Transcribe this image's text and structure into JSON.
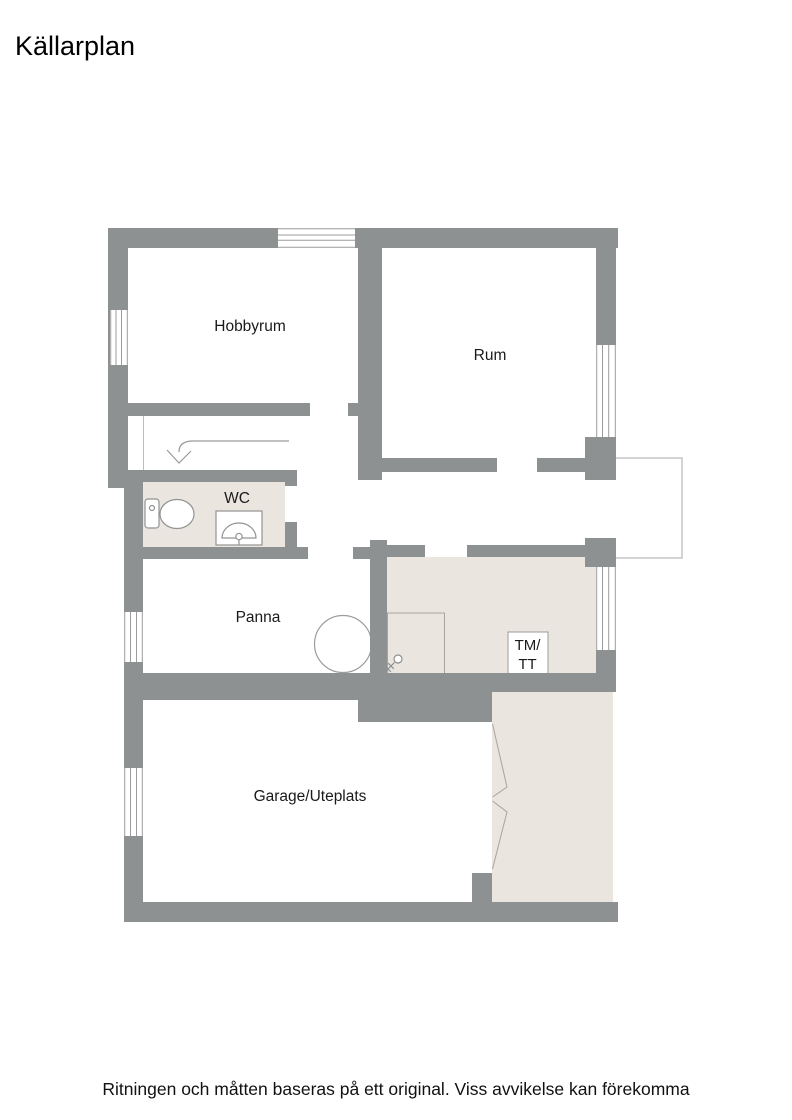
{
  "title": "Källarplan",
  "disclaimer": "Ritningen och måtten baseras på ett original. Viss avvikelse kan förekomma",
  "rooms": {
    "hobbyrum": "Hobbyrum",
    "rum": "Rum",
    "wc": "WC",
    "panna": "Panna",
    "garage": "Garage/Uteplats"
  },
  "appliances": {
    "washer_dryer_line1": "TM/",
    "washer_dryer_line2": "TT"
  },
  "icons": {
    "toilet": "toilet-icon",
    "sink": "sink-icon",
    "stairs_arrow": "stairs-down-arrow-icon",
    "boiler": "boiler-icon",
    "floor_drain": "floor-drain-icon",
    "folding_garage_door": "folding-door-icon",
    "window": "window-marker",
    "entrance_platform": "entrance-stoop"
  },
  "colors": {
    "wall": "#8E9192",
    "floor_accent": "#EAE5DF",
    "fixture_outline": "#9C9C9C",
    "platform_outline": "#C6C6C6",
    "text": "#1A1A1A"
  }
}
